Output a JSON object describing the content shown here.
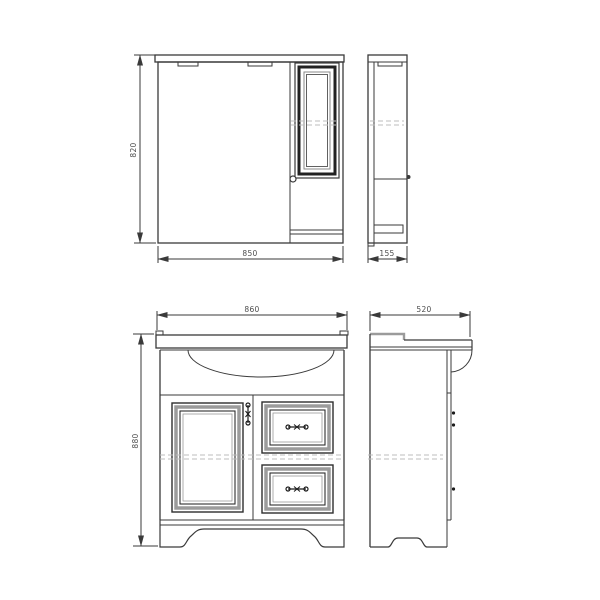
{
  "drawing": {
    "views": {
      "mirror_front": {
        "height": "820",
        "width": "850"
      },
      "mirror_side": {
        "depth": "155"
      },
      "vanity_front": {
        "width": "860",
        "height": "880"
      },
      "vanity_side": {
        "depth": "520"
      }
    },
    "colors": {
      "line": "#3a3a3a",
      "frame_gray": "#9b9b9b",
      "dash": "#bdbdbd",
      "label": "#4d4d4d",
      "background": "#ffffff"
    }
  }
}
